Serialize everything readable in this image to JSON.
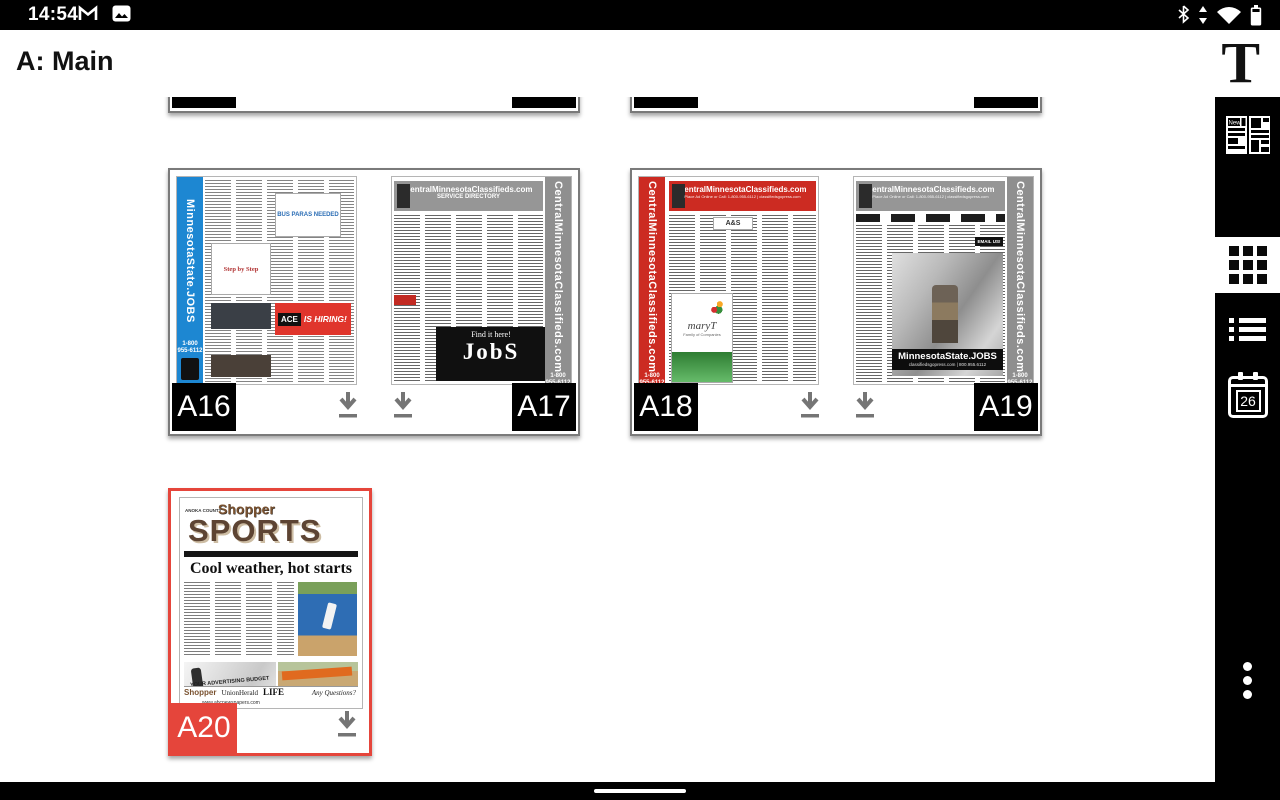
{
  "status_bar": {
    "time": "14:54",
    "notification_icons": [
      "gmail-icon",
      "photos-icon"
    ],
    "system_icons": [
      "bluetooth-icon",
      "data-transfer-icon",
      "wifi-icon",
      "battery-icon"
    ]
  },
  "app_bar": {
    "title": "A: Main",
    "logo": "T"
  },
  "sidebar": {
    "news_label": "News",
    "calendar_day": "26",
    "items": [
      "publication-pages",
      "grid-view",
      "list-view",
      "calendar-issues",
      "overflow-menu"
    ]
  },
  "cards": [
    {
      "left_label": "A12",
      "right_label": "A13"
    },
    {
      "left_label": "A14",
      "right_label": "A15"
    },
    {
      "left_label": "A16",
      "right_label": "A17"
    },
    {
      "left_label": "A18",
      "right_label": "A19"
    },
    {
      "label": "A20",
      "selected": true
    }
  ],
  "thumb": {
    "a16": {
      "side_text": "MinnesotaState.JOBS",
      "phone": "1-800 955-6112",
      "bus_ad": "BUS PARAS NEEDED",
      "step_ad": "Step by Step",
      "ace": "ACE",
      "hiring": "IS HIRING!"
    },
    "a17": {
      "header": "CentralMinnesotaClassifieds.com",
      "subheader": "SERVICE DIRECTORY",
      "side_text": "CentralMinnesotaClassifieds.com",
      "find_it": "Find it here!",
      "jobs": "JobS",
      "phone": "1-800 955-6112"
    },
    "a18": {
      "header": "CentralMinnesotaClassifieds.com",
      "header_sub": "Place Ad Online or Call: 1-800-955-6112 | classifiedsgopress.com",
      "ad_top": "A&S",
      "side_text": "CentralMinnesotaClassifieds.com",
      "mary": "maryT",
      "mary_sub": "Family of Companies",
      "phone": "1-800 955-6112"
    },
    "a19": {
      "header": "CentralMinnesotaClassifieds.com",
      "header_sub": "Place Ad Online or Call: 1-800-955-6112 | classifiedsgopress.com",
      "side_text": "CentralMinnesotaClassifieds.com",
      "email": "EMAIL US!",
      "jobs_banner": "MinnesotaState.JOBS",
      "jobs_sub": "classifiedsgopress.com | 800.955.6112",
      "phone": "1-800 955-6112"
    },
    "a20": {
      "county": "ANOKA COUNTY",
      "masthead": "Shopper",
      "section": "SPORTS",
      "headline": "Cool weather, hot starts",
      "ad_left": "YOUR ADVERTISING BUDGET",
      "footer_brand1": "Shopper",
      "footer_brand2": "UnionHerald",
      "footer_brand3": "LIFE",
      "questions": "Any Questions?",
      "site": "www.abcnewspapers.com"
    }
  },
  "colors": {
    "selected_red": "#e5453b",
    "blue_rail": "#1d87d2",
    "red_rail": "#cc2b22",
    "gray_rail": "#8f8f8f",
    "download_gray": "#757575"
  }
}
